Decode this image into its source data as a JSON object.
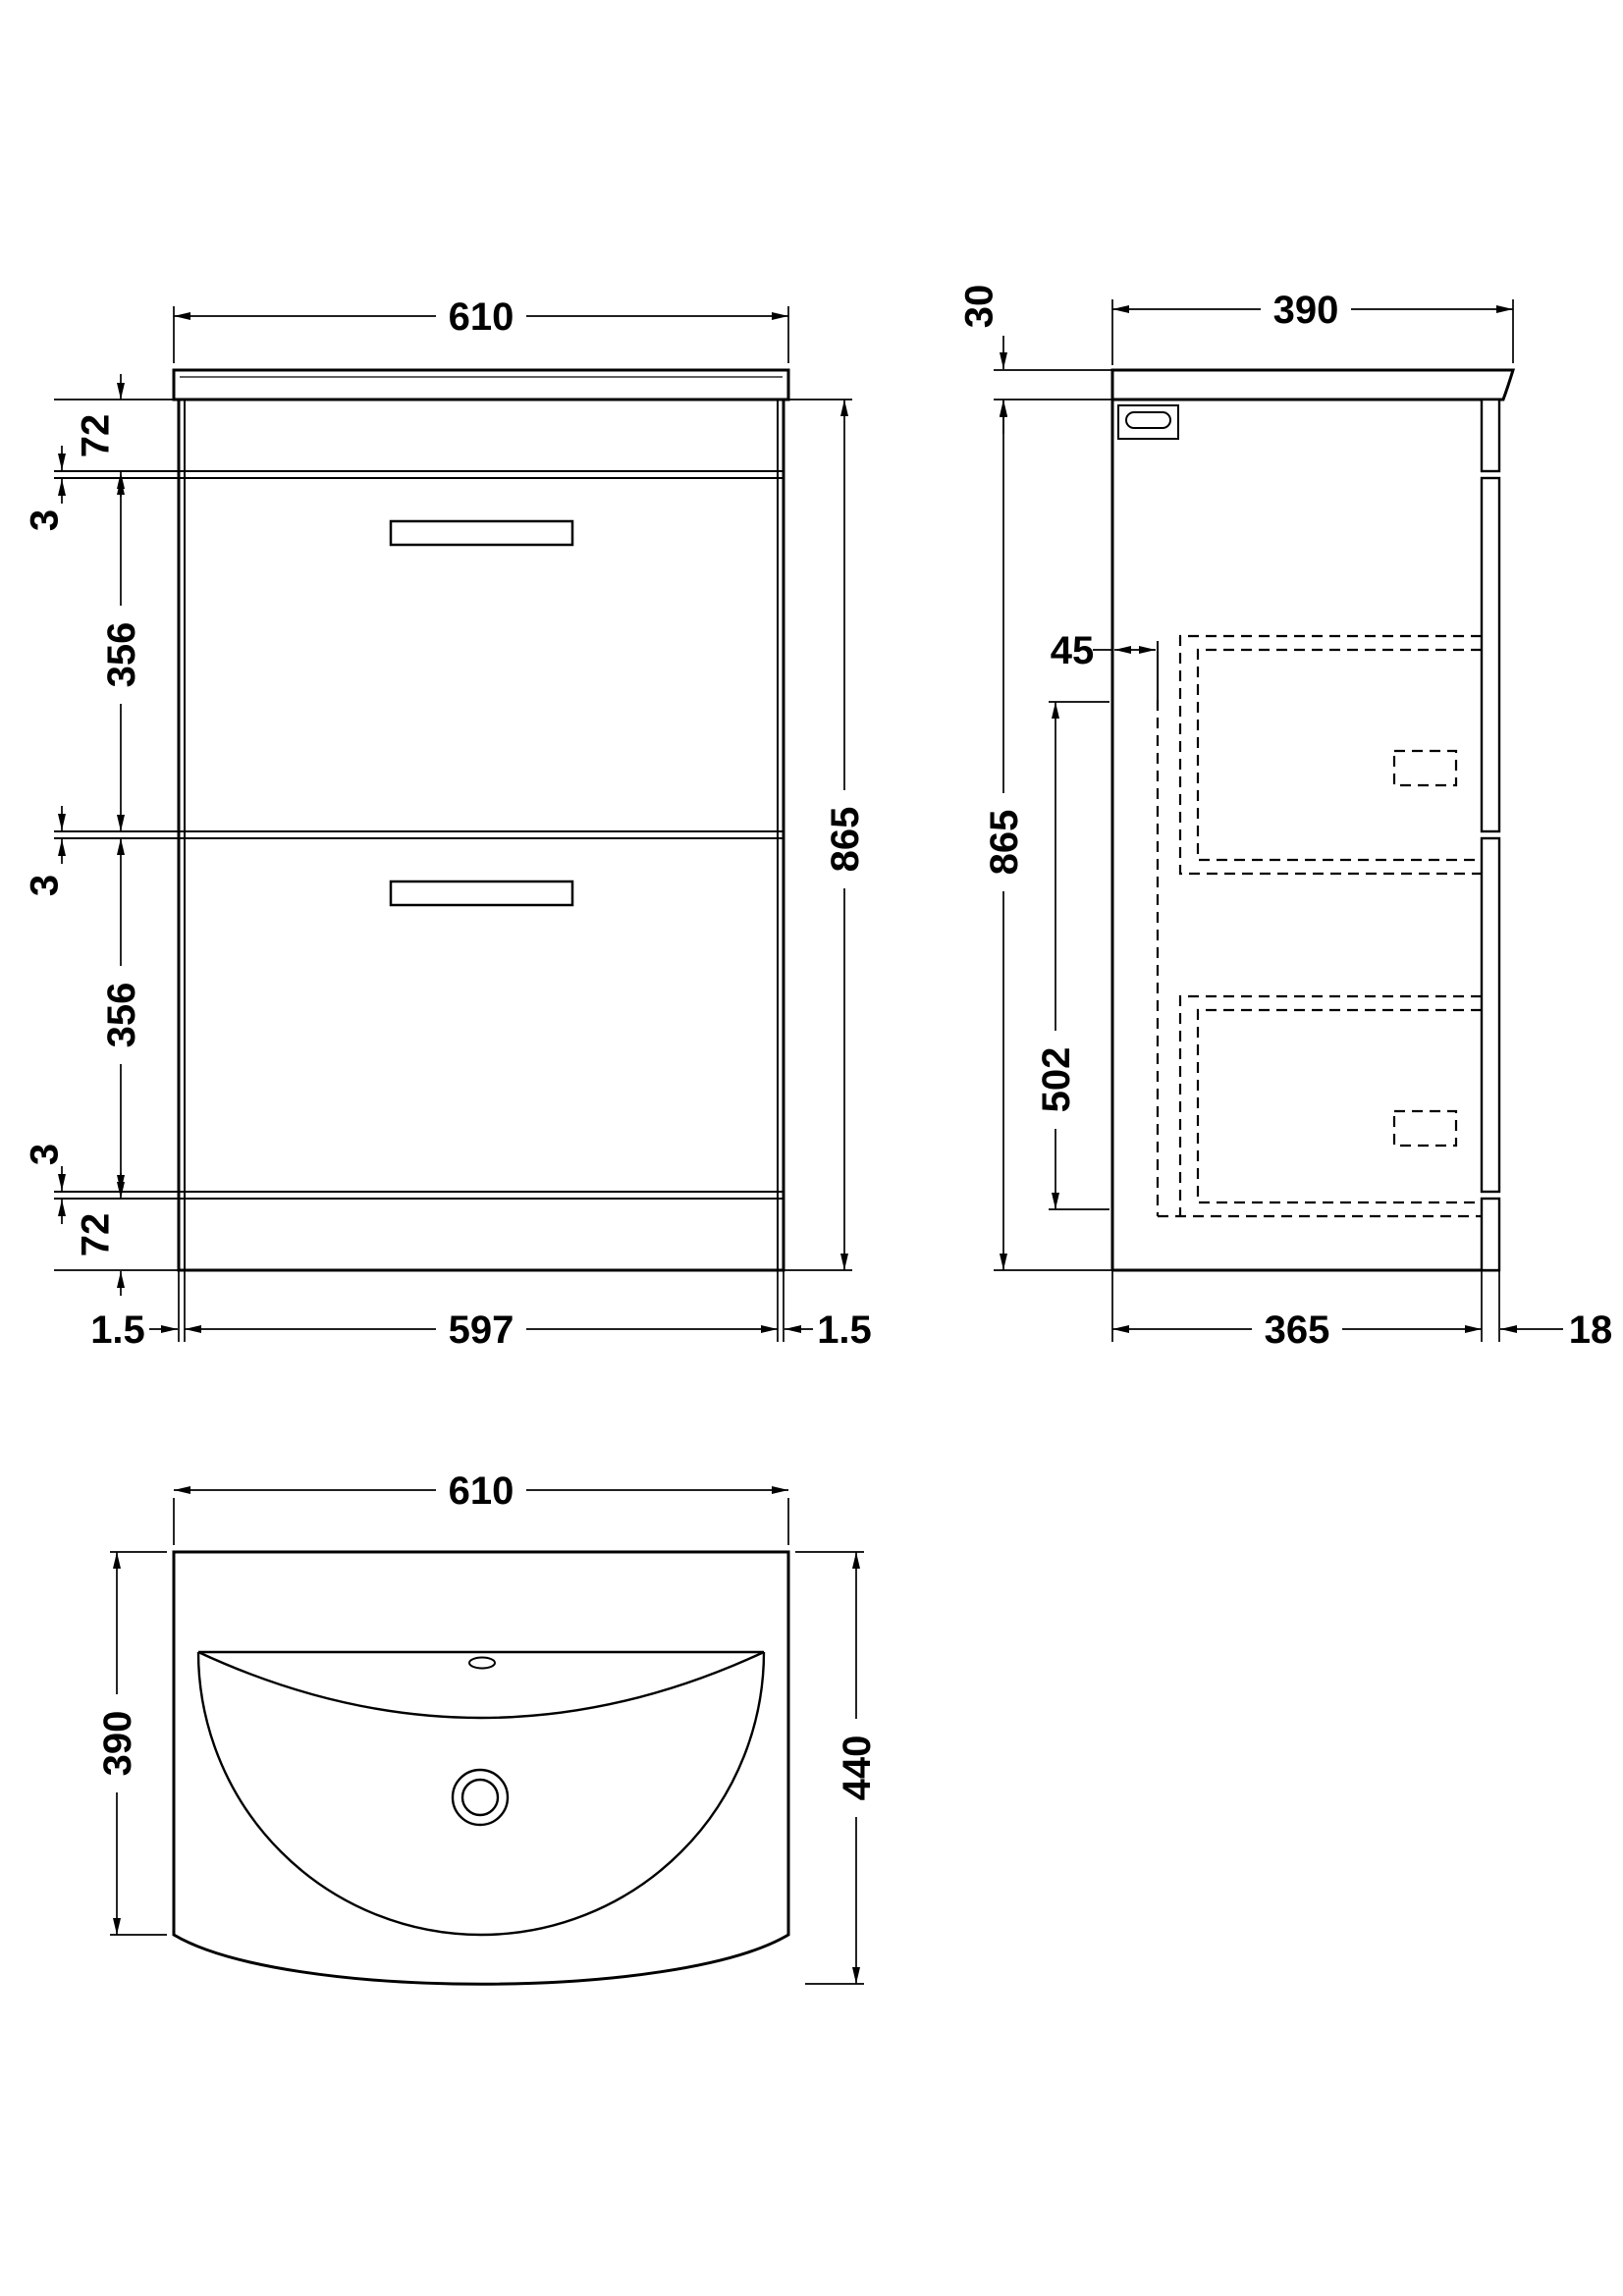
{
  "drawing": {
    "type": "technical-drawing",
    "subject": "bathroom vanity unit with basin, 2 drawers",
    "line_color": "#000000",
    "background_color": "#ffffff"
  },
  "views": {
    "front": {
      "name": "front-elevation",
      "dims": {
        "width_top": "610",
        "rail_top": "72",
        "gap_top": "3",
        "drawer1_height": "356",
        "gap_mid": "3",
        "drawer2_height": "356",
        "gap_bottom": "3",
        "rail_bottom": "72",
        "height_right": "865",
        "panel_left": "1.5",
        "width_internal": "597",
        "panel_right": "1.5"
      }
    },
    "side": {
      "name": "side-elevation",
      "dims": {
        "counter_thickness": "30",
        "depth_top": "390",
        "drawer_back_clearance": "45",
        "drawer_zone_height": "502",
        "height_left": "865",
        "depth_bottom": "365",
        "front_panel_thickness": "18"
      }
    },
    "plan": {
      "name": "plan-view",
      "dims": {
        "width_top": "610",
        "depth_left": "390",
        "depth_right": "440"
      }
    }
  }
}
